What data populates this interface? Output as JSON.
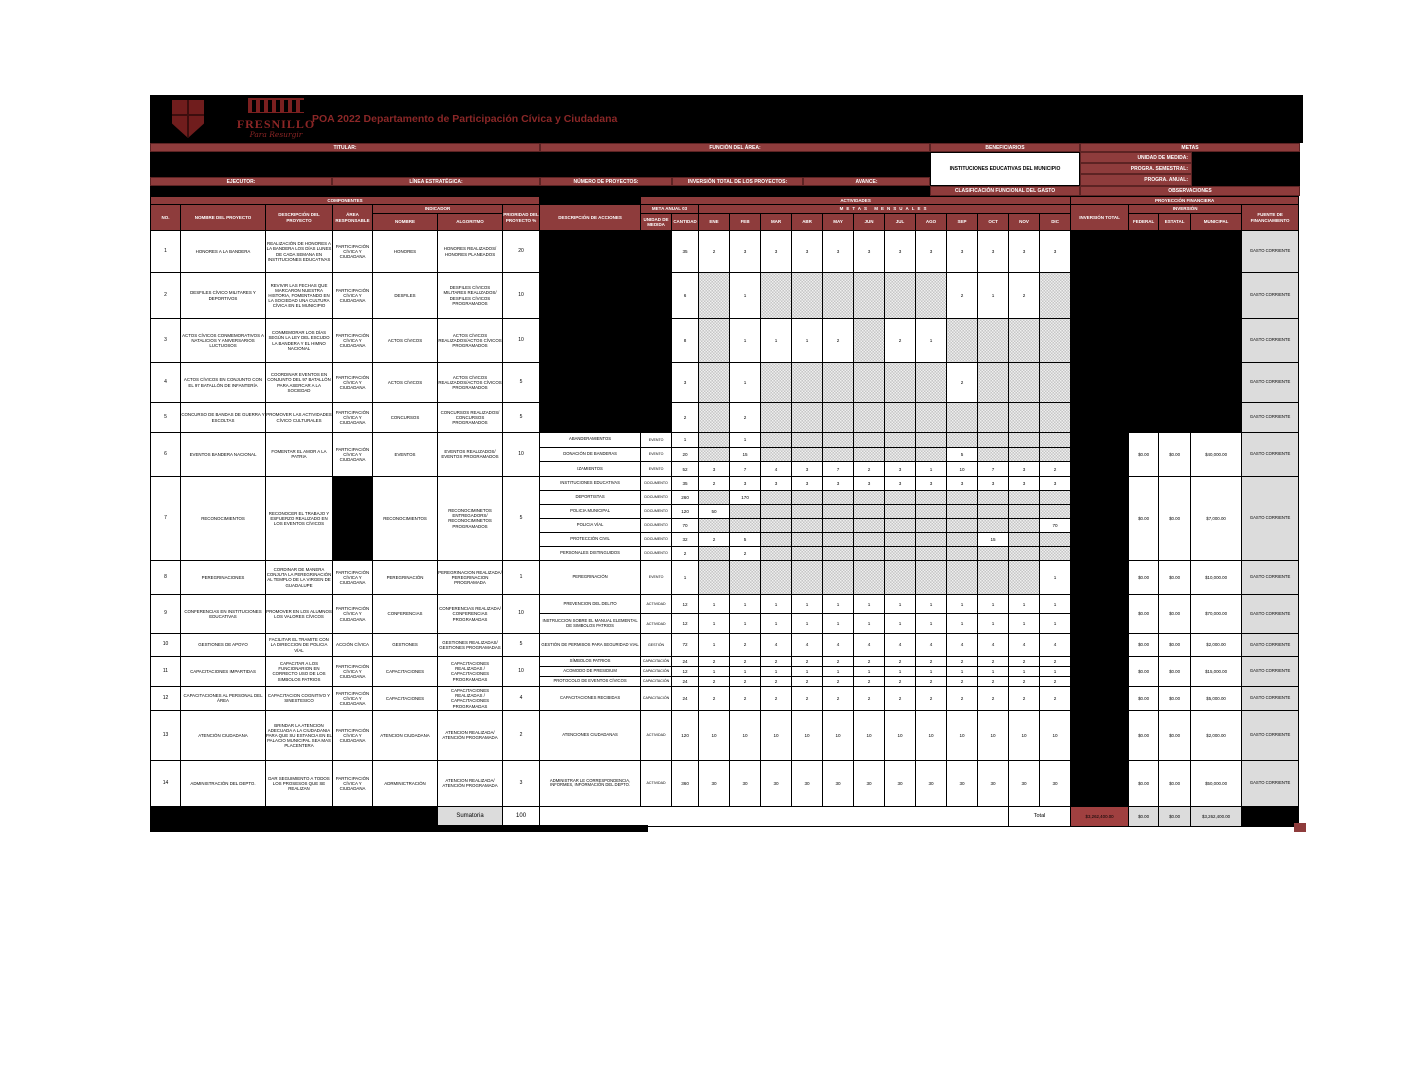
{
  "colors": {
    "accent_red": "#8e3c3c",
    "total_red": "#a04040",
    "black": "#000000",
    "gray_cell": "#dcdcdc",
    "title_red": "#8a2727"
  },
  "logo": {
    "wordmark": "FRESNILLO",
    "tagline": "Para Resurgir"
  },
  "page": {
    "title": "POA 2022 Departamento de Participación Cívica y Ciudadana"
  },
  "info": {
    "titular_label": "TITULAR:",
    "funcion_label": "FUNCIÓN DEL ÁREA:",
    "ejecutor_label": "EJECUTOR:",
    "linea_label": "LÍNEA ESTRATÉGICA:",
    "numero_label": "NÚMERO DE PROYECTOS:",
    "inversion_label": "INVERSIÓN TOTAL DE LOS PROYECTOS:",
    "avance_label": "AVANCE:",
    "beneficiarios_label": "BENEFICIARIOS",
    "beneficiarios_value": "INSTITUCIONES EDUCATIVAS DEL MUNICIPIO",
    "metas_label": "METAS",
    "unidad_medida_label": "UNIDAD DE MEDIDA:",
    "progra_semestral_label": "PROGRA. SEMESTRAL:",
    "progra_anual_label": "PROGRA. ANUAL:",
    "clasificacion_label": "CLASIFICACIÓN FUNCIONAL DEL GASTO",
    "observaciones_label": "OBSERVACIONES"
  },
  "table": {
    "headers": {
      "componentes": "COMPONENTES",
      "actividades": "ACTIVIDADES",
      "proyeccion": "PROYECCIÓN FINANCIERA",
      "no": "NO.",
      "nombre_proyecto": "NOMBRE DEL PROYECTO",
      "descripcion_proyecto": "DESCRIPCIÓN DEL PROYECTO",
      "area_responsable": "ÁREA RESPONSABLE",
      "indicador": "INDICADOR",
      "prioridad": "PRIORIDAD DEL PROYECTO %",
      "descripcion_acciones": "DESCRIPCIÓN DE ACCIONES",
      "meta_anual": "META ANUAL 03",
      "metas_mensuales": "METAS MENSUALES",
      "ind_nombre": "NOMBRE",
      "ind_algoritmo": "ALGORITMO",
      "unidad_medida": "UNIDAD DE MEDIDA",
      "cantidad": "CANTIDAD",
      "inversion_total": "INVERSIÓN TOTAL",
      "inversion": "INVERSIÓN",
      "federal": "FEDERAL",
      "estatal": "ESTATAL",
      "municipal": "MUNICIPAL",
      "fuente": "FUENTE DE FINANCIAMIENTO"
    },
    "months": [
      "ENE",
      "FEB",
      "MAR",
      "ABR",
      "MAY",
      "JUN",
      "JUL",
      "AGO",
      "SEP",
      "OCT",
      "NOV",
      "DIC"
    ],
    "projects": [
      {
        "no": "1",
        "nombre": "HONORES A LA BANDERA",
        "descripcion": "REALIZACIÓN DE HONORES A LA BANDERA LOS DÍAS LUNES DE CADA SEMANA EN INSTITUCIONES EDUCATIVAS",
        "area": "PARTICIPACIÓN CÍVICA Y CIUDADANA",
        "indicador": "HONORES",
        "algoritmo": "HONORES REALIZADOS/ HONORES PLANEADOS",
        "prioridad": "20",
        "cantidad": "35",
        "meses": [
          "2",
          "3",
          "3",
          "3",
          "3",
          "3",
          "3",
          "3",
          "3",
          "3",
          "3",
          "3"
        ],
        "money_black": true,
        "fuente": "GASTO CORRIENTE"
      },
      {
        "no": "2",
        "nombre": "DESFILES CÍVICO MILITARES Y DEPORTIVOS",
        "descripcion": "REVIVIR LAS FECHAS QUE MARCARON NUESTRA HISTORIA, FOMENTANDO EN LA SOCIEDAD UNA CULTURA CÍVICA EN EL MUNICIPIO",
        "area": "PARTICIPACIÓN CÍVICA Y CIUDADANA",
        "indicador": "DESFILES",
        "algoritmo": "DESFILES CÍVICOS MILITARES REALIZADOS/ DESFILES CÍVICOS PROGRAMADOS",
        "prioridad": "10",
        "cantidad": "6",
        "meses": [
          null,
          "1",
          null,
          null,
          null,
          null,
          null,
          null,
          "2",
          "1",
          "2",
          null
        ],
        "money_black": true,
        "fuente": "GASTO CORRIENTE"
      },
      {
        "no": "3",
        "nombre": "ACTOS CÍVICOS CONMEMORATIVOS A NATALICIOS Y ANIVERSARIOS LUCTUOSOS",
        "descripcion": "CONMEMORAR LOS DÍAS SEGÚN LA LEY DEL ESCUDO LA BANDERA Y EL HIMNO NACIONAL",
        "area": "PARTICIPACIÓN CÍVICA Y CIUDADANA",
        "indicador": "ACTOS CÍVICOS",
        "algoritmo": "ACTOS CÍVICOS REALIZADOS/ACTOS CÍVICOS PROGRAMADOS",
        "prioridad": "10",
        "cantidad": "8",
        "meses": [
          null,
          "1",
          "1",
          "1",
          "2",
          null,
          "2",
          "1",
          null,
          null,
          null,
          null
        ],
        "money_black": true,
        "fuente": "GASTO CORRIENTE"
      },
      {
        "no": "4",
        "nombre": "ACTOS CÍVICOS EN CONJUNTO CON EL 97 BATALLÓN DE INFANTERÍA",
        "descripcion": "COORDINAR EVENTOS EN CONJUNTO DEL 97 BATALLÓN PARA ASERCAR A LA SOCIEDAD",
        "area": "PARTICIPACIÓN CÍVICA Y CIUDADANA",
        "indicador": "ACTOS CÍVICOS",
        "algoritmo": "ACTOS CÍVICOS REALIZADOS/ACTOS CÍVICOS PROGRAMADOS",
        "prioridad": "5",
        "cantidad": "3",
        "meses": [
          null,
          "1",
          null,
          null,
          null,
          null,
          null,
          null,
          "2",
          null,
          null,
          null
        ],
        "money_black": true,
        "fuente": "GASTO CORRIENTE"
      },
      {
        "no": "5",
        "nombre": "CONCURSO DE BANDAS DE GUERRA Y ESCOLTAS",
        "descripcion": "PROMOVER LAS ACTIVIDADES CÍVICO CULTURALES",
        "area": "PARTICIPACIÓN CÍVICA Y CIUDADANA",
        "indicador": "CONCURSOS",
        "algoritmo": "CONCURSOS REALIZADOS/ CONCURSOS PROGRAMADOS",
        "prioridad": "5",
        "cantidad": "2",
        "meses": [
          null,
          "2",
          null,
          null,
          null,
          null,
          null,
          null,
          null,
          null,
          null,
          null
        ],
        "money_black": true,
        "fuente": "GASTO CORRIENTE"
      },
      {
        "no": "6",
        "nombre": "EVENTOS BANDERA NACIONAL",
        "descripcion": "FOMENTAR EL AMOR A LA PATRIA",
        "area": "PARTICIPACIÓN CÍVICA Y CIUDADANA",
        "indicador": "EVENTOS",
        "algoritmo": "EVENTOS REALIZADOS/ EVENTOS PROGRAMADOS",
        "prioridad": "10",
        "acciones": [
          {
            "desc": "ABANDERAMIENTOS",
            "unidad": "EVENTO",
            "cantidad": "1",
            "meses": [
              null,
              "1",
              null,
              null,
              null,
              null,
              null,
              null,
              null,
              null,
              null,
              null
            ]
          },
          {
            "desc": "DONACIÓN DE BANDERAS",
            "unidad": "EVENTO",
            "cantidad": "20",
            "meses": [
              null,
              "15",
              null,
              null,
              null,
              null,
              null,
              null,
              "5",
              null,
              null,
              null
            ]
          },
          {
            "desc": "IZAMIENTOS",
            "unidad": "EVENTO",
            "cantidad": "52",
            "meses": [
              "3",
              "7",
              "4",
              "3",
              "7",
              "2",
              "3",
              "1",
              "10",
              "7",
              "3",
              "2"
            ]
          }
        ],
        "federal": "$0.00",
        "estatal": "$0.00",
        "municipal": "$40,000.00",
        "fuente": "GASTO CORRIENTE"
      },
      {
        "no": "7",
        "nombre": "RECONOCIMIENTOS",
        "descripcion": "RECONOCER EL TRABAJO Y ESFUERZO REALIZADO EN LOS EVENTOS CÍVICOS",
        "area": "",
        "area_black": true,
        "indicador": "RECONOCIMIENTOS",
        "algoritmo": "RECONOCIMINETOS ENTREGADORS/ RECONOCIMINETOS PROGRAMADOS",
        "prioridad": "5",
        "acciones": [
          {
            "desc": "INSTITUCIONES EDUCATIVAS",
            "unidad": "DOCUMENTO",
            "cantidad": "35",
            "meses": [
              "2",
              "3",
              "3",
              "3",
              "3",
              "3",
              "3",
              "3",
              "3",
              "3",
              "3",
              "3"
            ]
          },
          {
            "desc": "DEPORTISTAS",
            "unidad": "DOCUMENTO",
            "cantidad": "260",
            "meses": [
              null,
              "170",
              null,
              null,
              null,
              null,
              null,
              null,
              null,
              null,
              null,
              null
            ]
          },
          {
            "desc": "POLICIA MUNICIPAL",
            "unidad": "DOCUMENTO",
            "cantidad": "120",
            "meses": [
              "50",
              null,
              null,
              null,
              null,
              null,
              null,
              null,
              null,
              null,
              null,
              null
            ]
          },
          {
            "desc": "POLICIA VÍAL",
            "unidad": "DOCUMENTO",
            "cantidad": "70",
            "meses": [
              null,
              null,
              null,
              null,
              null,
              null,
              null,
              null,
              null,
              null,
              null,
              "70"
            ]
          },
          {
            "desc": "PROTECCIÓN CIVIL",
            "unidad": "DOCUMENTO",
            "cantidad": "32",
            "meses": [
              "2",
              "5",
              null,
              null,
              null,
              null,
              null,
              null,
              null,
              "15",
              null,
              null
            ]
          },
          {
            "desc": "PERSONALES DISTINGUIDOS",
            "unidad": "DOCUMENTO",
            "cantidad": "2",
            "meses": [
              null,
              "2",
              null,
              null,
              null,
              null,
              null,
              null,
              null,
              null,
              null,
              null
            ]
          }
        ],
        "federal": "$0.00",
        "estatal": "$0.00",
        "municipal": "$7,000.00",
        "fuente": "GASTO CORRIENTE"
      },
      {
        "no": "8",
        "nombre": "PEREGRINACIONES",
        "descripcion": "CORDINAR DE MANERA CONJUTA LA PEREGRINACIÓN AL TEMPLO DE LA VIRGEN DE GUADALUPE",
        "area": "PARTICIPACIÓN CÍVICA Y CIUDADANA",
        "indicador": "PEREGRINACIÓN",
        "algoritmo": "PEREGRINACION REALIZADA/ PEREGRINACION PROGRAMADA",
        "prioridad": "1",
        "acciones": [
          {
            "desc": "PEREGRINACIÓN",
            "unidad": "EVENTO",
            "cantidad": "1",
            "meses": [
              null,
              null,
              null,
              null,
              null,
              null,
              null,
              null,
              null,
              null,
              null,
              "1"
            ]
          }
        ],
        "federal": "$0.00",
        "estatal": "$0.00",
        "municipal": "$10,000.00",
        "fuente": "GASTO CORRIENTE"
      },
      {
        "no": "9",
        "nombre": "CONFERENCIAS EN INSTITUCIONES EDUCATIVAS",
        "descripcion": "PROMOVER EN LOS ALUMNOS LOS VALORES CÍVICOS",
        "area": "PARTICIPACIÓN CÍVICA Y CIUDADANA",
        "indicador": "CONFERENCIAS",
        "algoritmo": "CONFERENCIAS REALIZADA/ CONFERENCIAS PROGRAMADAS",
        "prioridad": "10",
        "acciones": [
          {
            "desc": "PREVENCION DEL DELITO",
            "unidad": "ACTIVIDAD",
            "cantidad": "12",
            "meses": [
              "1",
              "1",
              "1",
              "1",
              "1",
              "1",
              "1",
              "1",
              "1",
              "1",
              "1",
              "1"
            ]
          },
          {
            "desc": "INSTRUCCION SOBRE EL MANUAL ELEMENTAL DE SIMBOLOS PATRIOS",
            "unidad": "ACTIVIDAD",
            "cantidad": "12",
            "meses": [
              "1",
              "1",
              "1",
              "1",
              "1",
              "1",
              "1",
              "1",
              "1",
              "1",
              "1",
              "1"
            ]
          }
        ],
        "federal": "$0.00",
        "estatal": "$0.00",
        "municipal": "$70,000.00",
        "fuente": "GASTO CORRIENTE"
      },
      {
        "no": "10",
        "nombre": "GESTIONES DE APOYO",
        "descripcion": "FACILITAR EL TRAMITE CON LA DIRECCION DE POLICIA VÍAL",
        "area": "ACCIÓN CÍVICA",
        "indicador": "GESTIONES",
        "algoritmo": "GESTIONES REALIZADAS/ GESTIONES PROGRAMADAS",
        "prioridad": "5",
        "acciones": [
          {
            "desc": "GESTIÓN DE PERMISOS PARA SEGURIDAD VIAL",
            "unidad": "GESTIÓN",
            "cantidad": "72",
            "meses": [
              "1",
              "2",
              "4",
              "4",
              "4",
              "4",
              "4",
              "4",
              "4",
              "4",
              "4",
              "4"
            ]
          }
        ],
        "federal": "$0.00",
        "estatal": "$0.00",
        "municipal": "$2,000.00",
        "fuente": "GASTO CORRIENTE"
      },
      {
        "no": "11",
        "nombre": "CAPACITACIONES IMPARTIDAS",
        "descripcion": "CAPACITAR A LOS FUNCIONARION EN CORRECTO USO DE LOS SIMBOLOS PATRIOS",
        "area": "PARTICIPACIÓN CÍVICA Y CIUDADANA",
        "indicador": "CAPACITACIONES",
        "algoritmo": "CAPACITACIONES REALIZADAS / CAPACITACIONES PROGRAMADAS",
        "prioridad": "10",
        "acciones": [
          {
            "desc": "SÍMBOLOS PATRIOS",
            "unidad": "CAPACITACIÓN",
            "cantidad": "24",
            "meses": [
              "2",
              "2",
              "2",
              "2",
              "2",
              "2",
              "2",
              "2",
              "2",
              "2",
              "2",
              "2"
            ]
          },
          {
            "desc": "ACOMODO DE PRESIDIUM",
            "unidad": "CAPACITACIÓN",
            "cantidad": "12",
            "meses": [
              "1",
              "1",
              "1",
              "1",
              "1",
              "1",
              "1",
              "1",
              "1",
              "1",
              "1",
              "1"
            ]
          },
          {
            "desc": "PROTOCOLO DE EVENTOS CÍVICOS",
            "unidad": "CAPACITACIÓN",
            "cantidad": "24",
            "meses": [
              "2",
              "2",
              "2",
              "2",
              "2",
              "2",
              "2",
              "2",
              "2",
              "2",
              "2",
              "2"
            ]
          }
        ],
        "federal": "$0.00",
        "estatal": "$0.00",
        "municipal": "$15,000.00",
        "fuente": "GASTO CORRIENTE"
      },
      {
        "no": "12",
        "nombre": "CAPACITACIONES AL PERSONAL DEL ÁREA",
        "descripcion": "CAPACITACION COGNITIVO Y SINESTESICO",
        "area": "PARTICIPACIÓN CÍVICA Y CIUDADANA",
        "indicador": "CAPACITACIONES",
        "algoritmo": "CAPACITACIONES REALIZADAS / CAPACITACIONES PROGRAMADAS",
        "prioridad": "4",
        "acciones": [
          {
            "desc": "CAPACITACIONES RECIBIDAS",
            "unidad": "CAPACITACIÓN",
            "cantidad": "24",
            "meses": [
              "2",
              "2",
              "2",
              "2",
              "2",
              "2",
              "2",
              "2",
              "2",
              "2",
              "2",
              "2"
            ]
          }
        ],
        "federal": "$0.00",
        "estatal": "$0.00",
        "municipal": "$5,000.00",
        "fuente": "GASTO CORRIENTE"
      },
      {
        "no": "13",
        "nombre": "ATENCIÓN CIUDADANA",
        "descripcion": "BRINDAR LA ATENCION ADECUADA A LA CIUDADANIA PARA QUE SU ESTANCIA EN EL PALACIO MUNICIPAL SEA MAS PLACENTERA",
        "area": "PARTICIPACIÓN CÍVICA Y CIUDADANA",
        "indicador": "ATENCION CIUDADANA",
        "algoritmo": "ATENCION REALIZADA/ ATENCIÓN PROGRAMADA",
        "prioridad": "2",
        "acciones": [
          {
            "desc": "ATENCIONES CIUDADANAS",
            "unidad": "ACTIVIDAD",
            "cantidad": "120",
            "meses": [
              "10",
              "10",
              "10",
              "10",
              "10",
              "10",
              "10",
              "10",
              "10",
              "10",
              "10",
              "10"
            ]
          }
        ],
        "federal": "$0.00",
        "estatal": "$0.00",
        "municipal": "$2,000.00",
        "fuente": "GASTO CORRIENTE"
      },
      {
        "no": "14",
        "nombre": "ADMINISTRACIÓN DEL DEPTO.",
        "descripcion": "DAR SEGUIMIENTO A TODOS LOS PROSESOS QUE SE REALIZAN",
        "area": "PARTICIPACIÓN CÍVICA Y CIUDADANA",
        "indicador": "ADRMINICTRACIÓN",
        "algoritmo": "ATENCION REALIZADA/ ATENCIÓN PROGRAMADA",
        "prioridad": "3",
        "acciones": [
          {
            "desc": "ADMINISTRAR LE CORRESPONDENCIA, INFORMES, INFORMACIÓN DEL DEPTO.",
            "unidad": "ACTIVIDAD",
            "cantidad": "360",
            "meses": [
              "30",
              "30",
              "30",
              "30",
              "30",
              "30",
              "30",
              "30",
              "30",
              "30",
              "30",
              "30"
            ]
          }
        ],
        "federal": "$0.00",
        "estatal": "$0.00",
        "municipal": "$50,000.00",
        "fuente": "GASTO CORRIENTE"
      }
    ],
    "footer": {
      "sumatoria_label": "Sumatoria",
      "sumatoria_value": "100",
      "total_label": "Total",
      "total_inversion": "$3,262,400.00",
      "total_federal": "$0.00",
      "total_estatal": "$0.00",
      "total_municipal": "$3,262,400.00"
    }
  }
}
